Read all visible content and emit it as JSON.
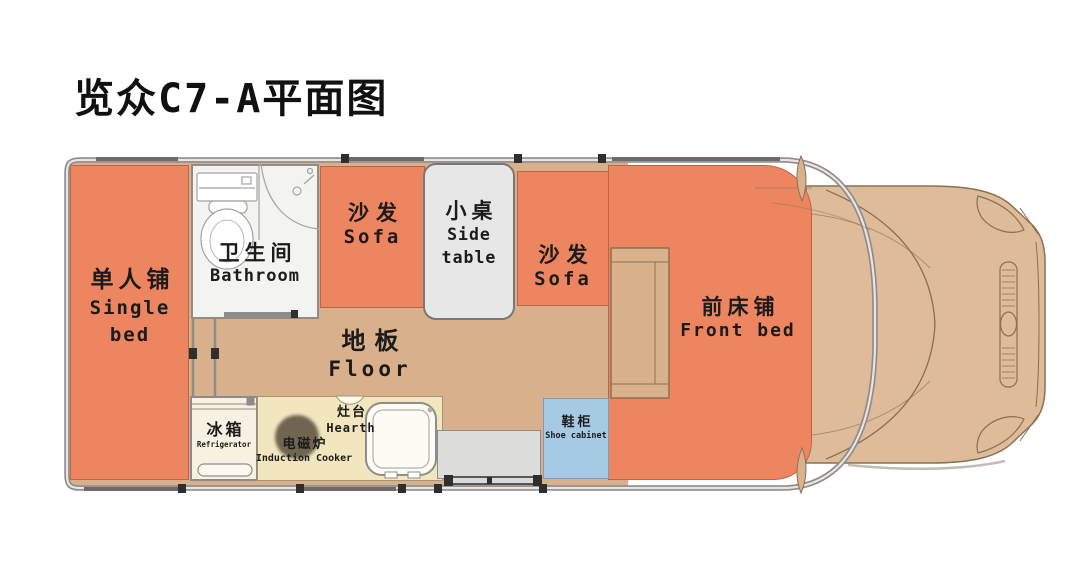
{
  "title": "览众C7-A平面图",
  "areas": {
    "single_bed": {
      "zh": "单人铺",
      "en": "Single\nbed"
    },
    "bathroom": {
      "zh": "卫生间",
      "en": "Bathroom"
    },
    "sofa_left": {
      "zh": "沙发",
      "en": "Sofa"
    },
    "side_table": {
      "zh": "小桌",
      "en": "Side\ntable"
    },
    "sofa_right": {
      "zh": "沙发",
      "en": "Sofa"
    },
    "floor": {
      "zh": "地板",
      "en": "Floor"
    },
    "front_bed": {
      "zh": "前床铺",
      "en": "Front bed"
    },
    "refrigerator": {
      "zh": "冰箱",
      "en": "Refrigerator"
    },
    "induction_cooker": {
      "zh": "电磁炉",
      "en": "Induction Cooker"
    },
    "hearth": {
      "zh": "灶台",
      "en": "Hearth"
    },
    "shoe_cabinet": {
      "zh": "鞋柜",
      "en": "Shoe cabinet"
    }
  },
  "colors": {
    "furniture_orange": "#ED8660",
    "floor_tan": "#D9B08C",
    "cab_tan": "#DEBB99",
    "kitchen_cream": "#F2E6BE",
    "fridge_cream": "#F6F1E0",
    "shoe_cabinet_blue": "#A6CAE4",
    "bathroom_white": "#F3F3F1",
    "side_table_gray": "#E7E7E7",
    "entry_step_gray": "#DCDCDA",
    "wall_gray": "#8F8B8B"
  }
}
